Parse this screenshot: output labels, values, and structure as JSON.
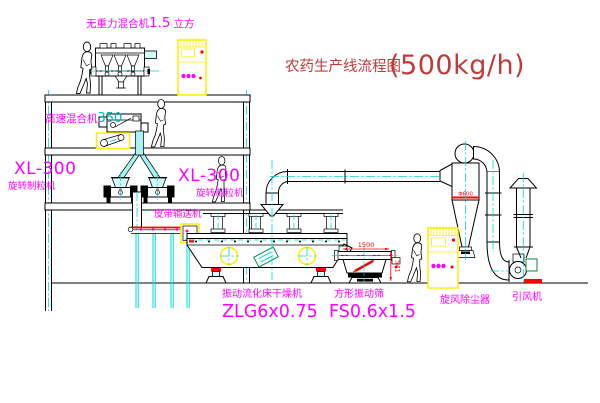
{
  "title": {
    "name": "农药生产线流程图",
    "capacity": "(500kg/h)"
  },
  "equipment": {
    "gravity_mixer": {
      "name": "无重力混合机",
      "size": "1.5",
      "unit": "立方"
    },
    "high_speed_mixer": {
      "name": "高速混合机",
      "model": "350"
    },
    "granulator_left": {
      "model": "XL-300",
      "name": "旋转制粒机"
    },
    "granulator_right": {
      "model": "XL-300",
      "name": "旋转制粒机"
    },
    "belt_conveyor": {
      "name": "皮带输送机"
    },
    "fluid_bed_dryer": {
      "name": "振动流化床干燥机",
      "model": "ZLG6x0.75"
    },
    "vibrating_screen": {
      "name": "方形振动筛",
      "model": "FS0.6x1.5"
    },
    "cyclone": {
      "name": "旋风除尘器",
      "diameter": "Φ600"
    },
    "fan": {
      "name": "引风机"
    }
  },
  "dimensions": {
    "screen_width": "1500",
    "screen_height": "541"
  },
  "colors": {
    "title_red": "#c23b3b",
    "label_magenta": "#ff00ff",
    "dim_red": "#ff0000",
    "pipe_cyan": "#00d9d9",
    "cabinet_yellow": "#ffee00",
    "line_black": "#000000"
  }
}
